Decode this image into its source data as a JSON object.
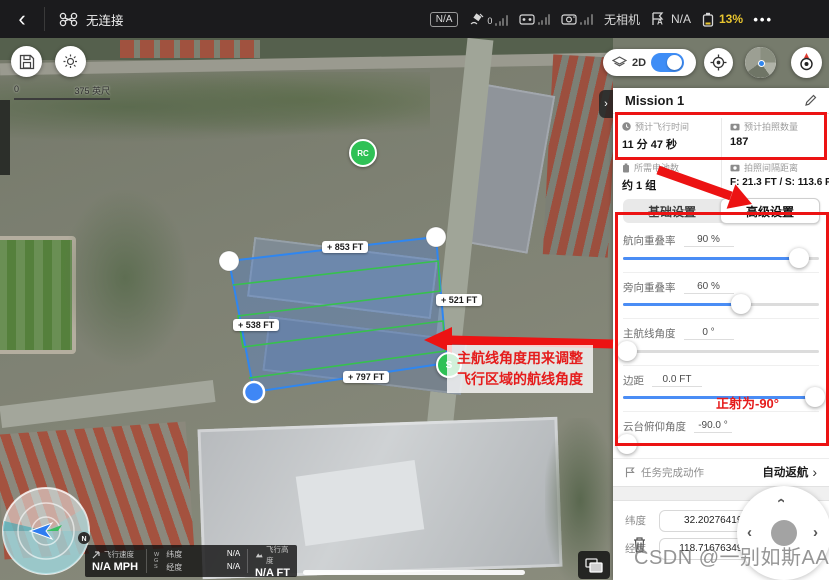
{
  "top_bar": {
    "back": "‹",
    "aircraft_status": "无连接",
    "na_badge": "N/A",
    "gps_count": "0",
    "camera_status": "无相机",
    "flight_mode_value": "N/A",
    "battery_percent": "13%",
    "more": "•••"
  },
  "map": {
    "scale_zero": "0",
    "scale_total": "375 英尺",
    "mode_label": "2D",
    "rc_marker": "RC",
    "start_marker": "S",
    "compass_north": "N",
    "edge_labels": {
      "top": "+ 853 FT",
      "right": "+ 521 FT",
      "left": "+ 538 FT",
      "bottom": "+ 797 FT"
    }
  },
  "annotations": {
    "route_note_line1": "主航线角度用来调整",
    "route_note_line2": "飞行区域的航线角度",
    "gimbal_note": "正射为-90°"
  },
  "panel": {
    "title": "Mission 1",
    "stats": [
      {
        "label": "预计飞行时间",
        "value": "11 分 47 秒"
      },
      {
        "label": "预计拍照数量",
        "value": "187"
      },
      {
        "label": "所需电池数",
        "value": "约 1 组"
      },
      {
        "label": "拍照间隔距离",
        "value": "F: 21.3 FT / S: 113.6 FT"
      }
    ],
    "tabs": [
      {
        "label": "基础设置"
      },
      {
        "label": "高级设置"
      }
    ],
    "sliders": [
      {
        "label": "航向重叠率",
        "value": "90 %",
        "percent": 90
      },
      {
        "label": "旁向重叠率",
        "value": "60 %",
        "percent": 60
      },
      {
        "label": "主航线角度",
        "value": "0 °",
        "percent": 2
      },
      {
        "label": "边距",
        "value": "0.0 FT",
        "percent": 98
      },
      {
        "label": "云台俯仰角度",
        "value": "-90.0 °",
        "percent": 2
      }
    ],
    "finish_action_label": "任务完成动作",
    "finish_action_value": "自动返航",
    "finish_action_chevron": "›",
    "coords": [
      {
        "label": "纬度",
        "value": "32.202764195"
      },
      {
        "label": "经度",
        "value": "118.716763493"
      }
    ]
  },
  "telemetry": {
    "speed_label": "飞行速度",
    "speed_value": "N/A MPH",
    "wgs_w": "W",
    "wgs_g": "G",
    "wgs_s": "S",
    "lat_label": "纬度",
    "lat_value": "N/A",
    "lon_label": "经度",
    "lon_value": "N/A",
    "alt_label": "飞行高度",
    "alt_value": "N/A FT"
  },
  "watermark": "CSDN @一别如斯AA",
  "colors": {
    "accent_blue": "#3e8df6",
    "takeoff_blue": "#2f9ad8",
    "annotation_red": "#ec1313",
    "battery_warning": "#e8c52f",
    "polygon_blue": "#2f86f0",
    "path_green": "#37c14e"
  }
}
